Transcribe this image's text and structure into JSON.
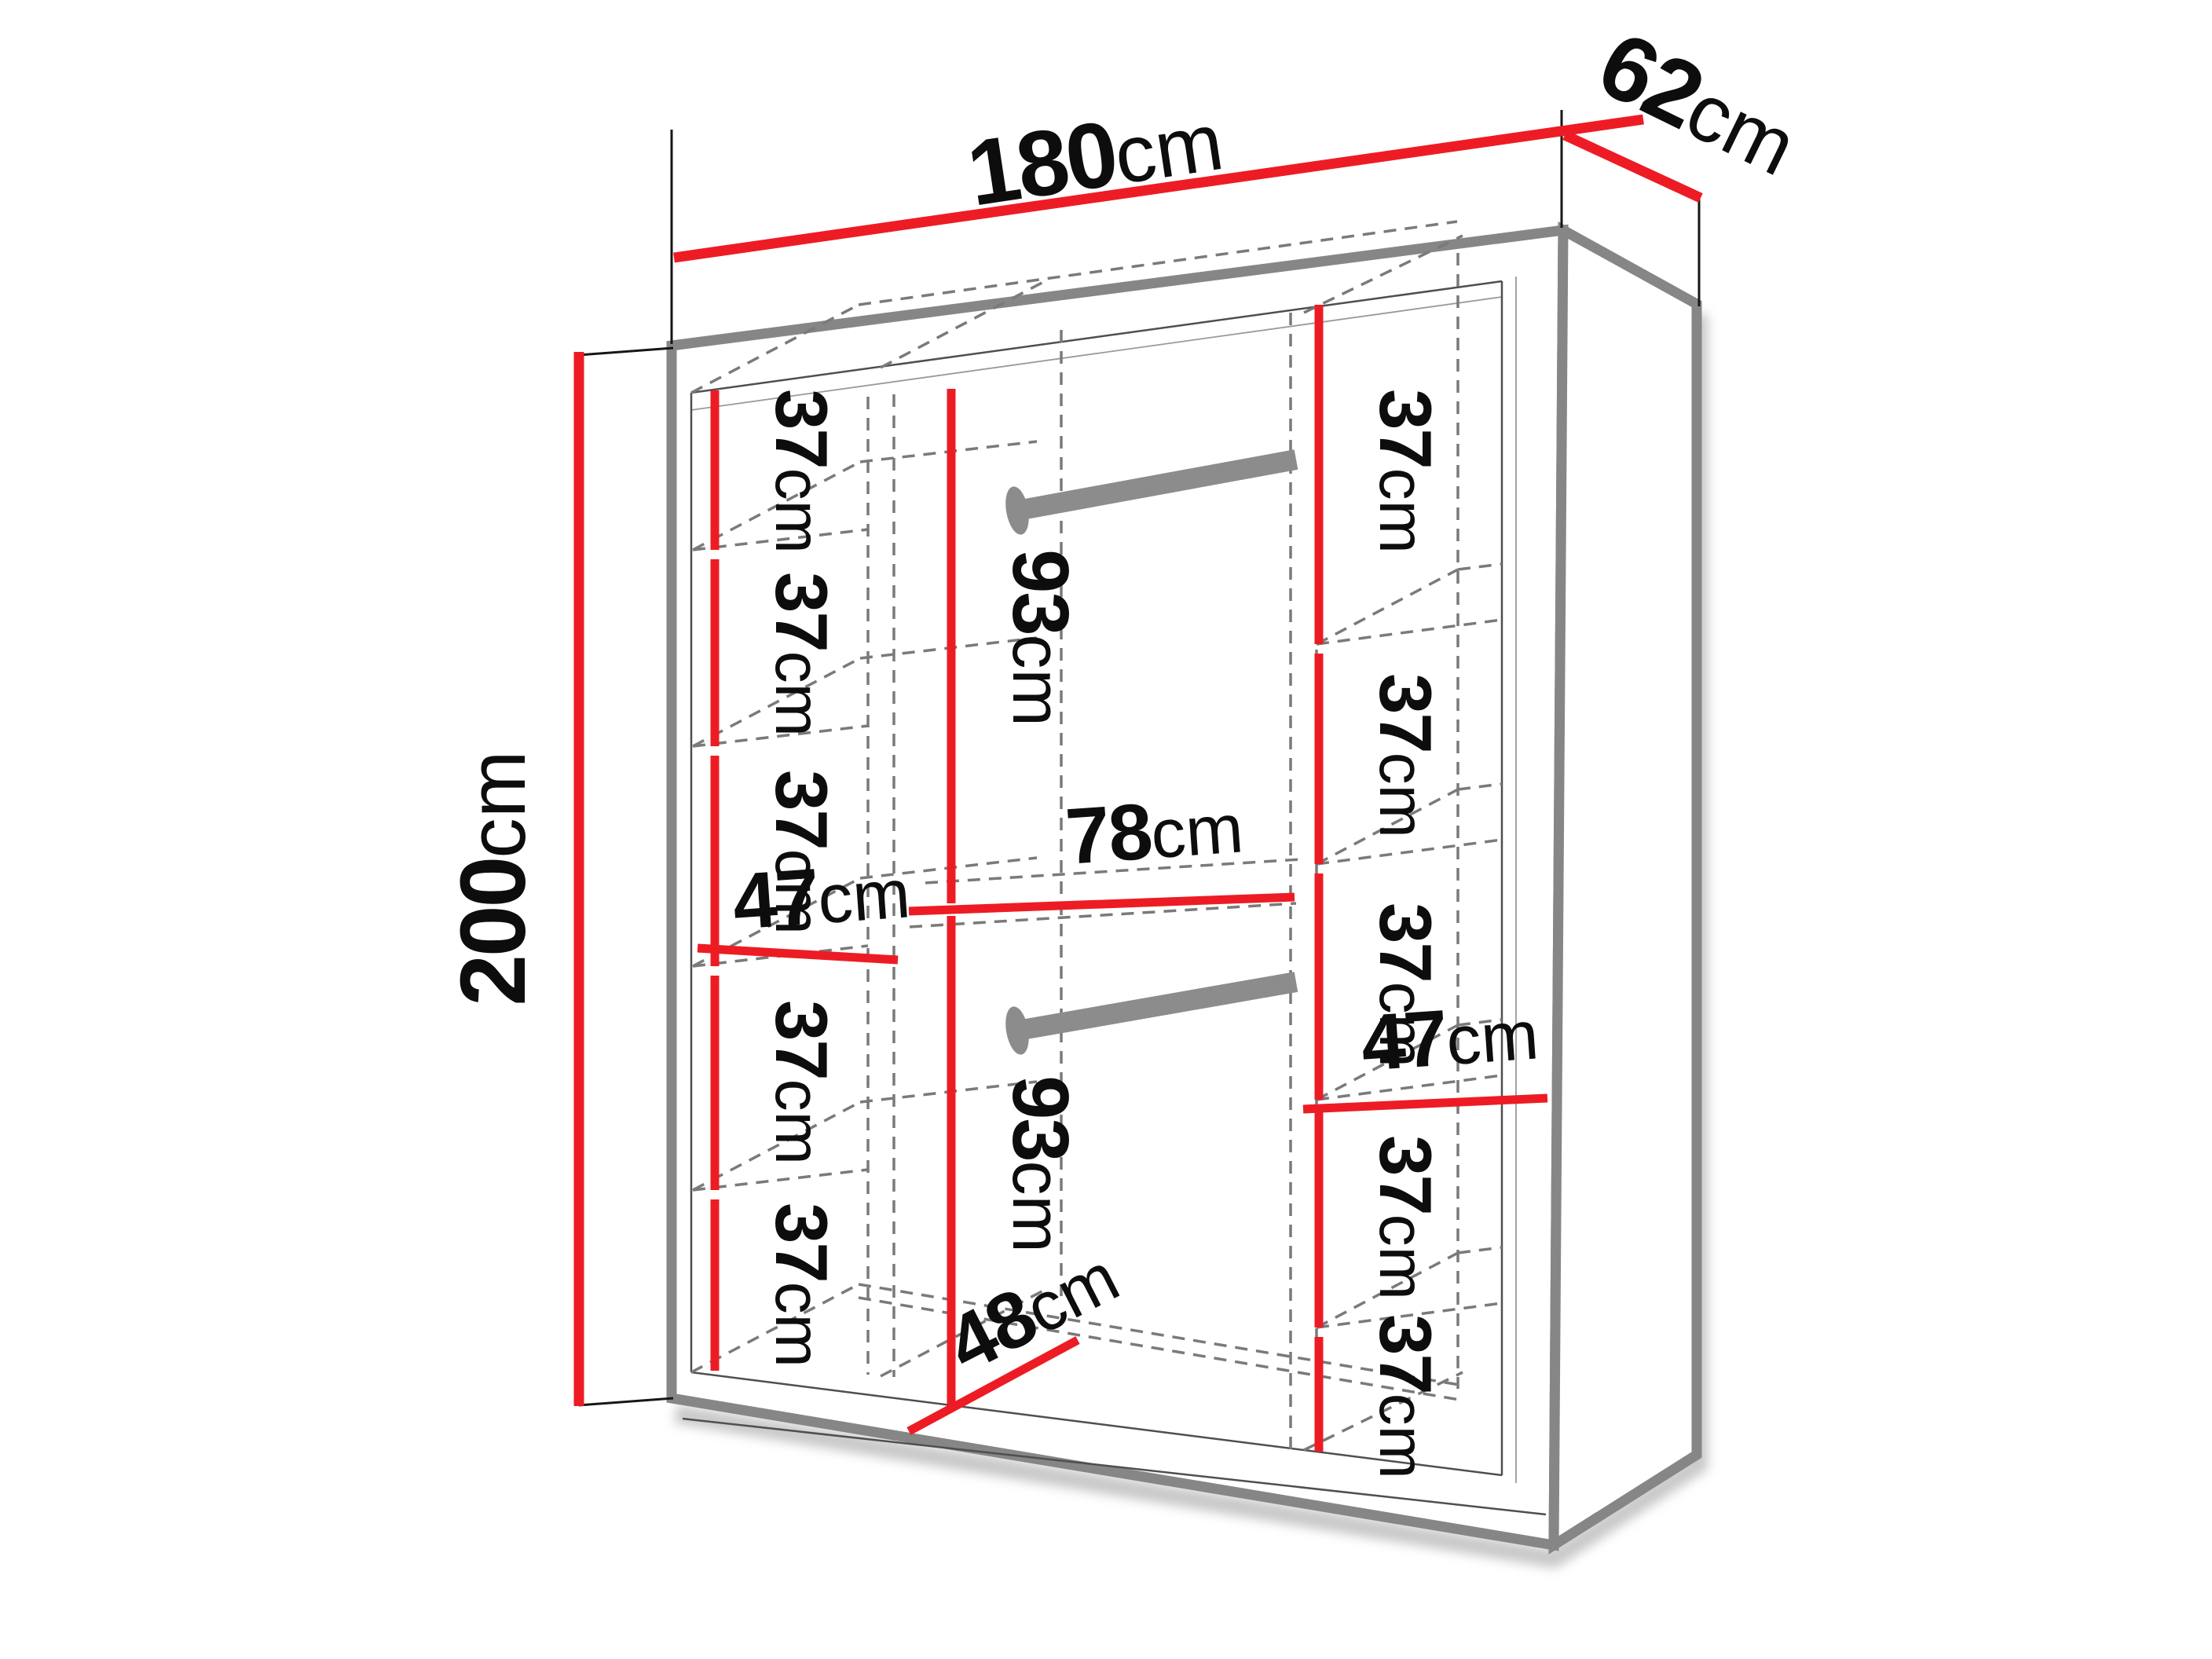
{
  "diagram": {
    "name": "wardrobe-dimension-diagram",
    "colors": {
      "dimension_red": "#ED1C24",
      "outline_grey": "#868686",
      "dashed_grey": "#7a7a7a",
      "rail_grey": "#8C8C8C",
      "text_black": "#0d0d0d"
    },
    "overall": {
      "width": {
        "value": "180",
        "unit": "cm"
      },
      "depth": {
        "value": "62",
        "unit": "cm"
      },
      "height": {
        "value": "200",
        "unit": "cm"
      }
    },
    "left_column": {
      "width": {
        "value": "47",
        "unit": "cm"
      },
      "shelf_gaps": [
        {
          "value": "37",
          "unit": "cm"
        },
        {
          "value": "37",
          "unit": "cm"
        },
        {
          "value": "37",
          "unit": "cm"
        },
        {
          "value": "37",
          "unit": "cm"
        },
        {
          "value": "37",
          "unit": "cm"
        }
      ]
    },
    "middle_section": {
      "width": {
        "value": "78",
        "unit": "cm"
      },
      "depth": {
        "value": "48",
        "unit": "cm"
      },
      "upper_hanging": {
        "value": "93",
        "unit": "cm"
      },
      "lower_hanging": {
        "value": "93",
        "unit": "cm"
      }
    },
    "right_column": {
      "width": {
        "value": "47",
        "unit": "cm"
      },
      "shelf_gaps": [
        {
          "value": "37",
          "unit": "cm"
        },
        {
          "value": "37",
          "unit": "cm"
        },
        {
          "value": "37",
          "unit": "cm"
        },
        {
          "value": "37",
          "unit": "cm"
        },
        {
          "value": "37",
          "unit": "cm"
        }
      ]
    }
  }
}
